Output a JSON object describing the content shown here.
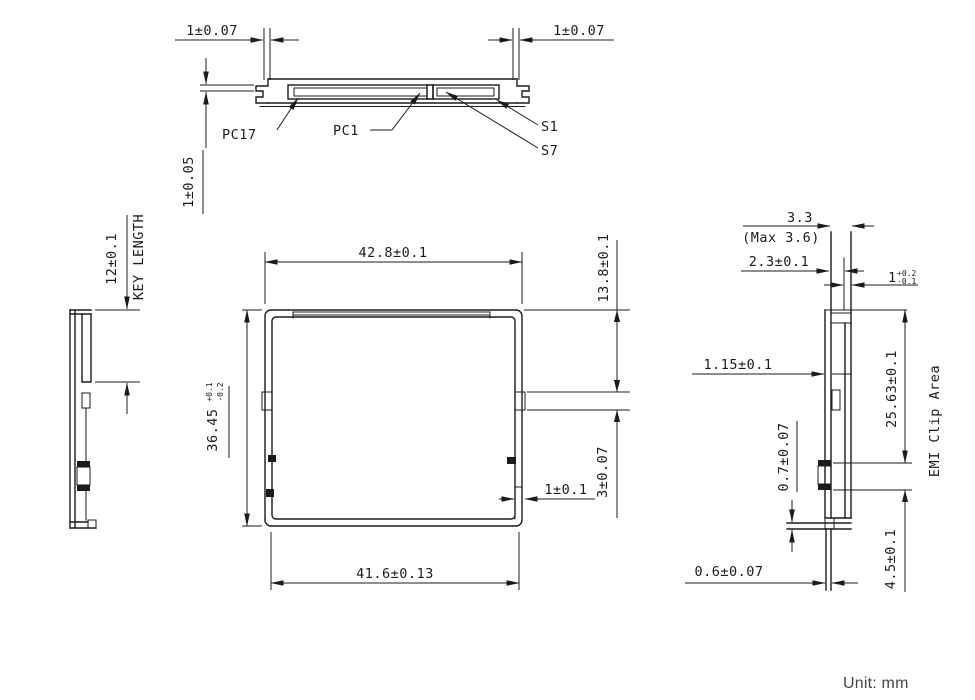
{
  "colors": {
    "line": "#1b1b1b",
    "note_text": "#454545",
    "background": "#ffffff"
  },
  "top_view": {
    "dim_left": "1±0.07",
    "dim_right": "1±0.07",
    "dim_lip": "1±0.05",
    "labels": {
      "pc17": "PC17",
      "pc1": "PC1",
      "s1": "S1",
      "s7": "S7"
    }
  },
  "left_view": {
    "dim_key": "12±0.1",
    "key_caption": "KEY LENGTH"
  },
  "front_view": {
    "dim_width_top": "42.8±0.1",
    "dim_height": {
      "value": "36.45",
      "tol_plus": "+0.1",
      "tol_minus": "-0.2"
    },
    "dim_width_bottom": "41.6±0.13",
    "dim_conn_offset": "13.8±0.1",
    "dim_conn_height": "3±0.07",
    "dim_step": "1±0.1"
  },
  "right_view": {
    "dim_thickness": "3.3",
    "dim_thickness_max": "(Max 3.6)",
    "dim_sub": "2.3±0.1",
    "dim_lip": {
      "value": "1",
      "tol_plus": "+0.2",
      "tol_minus": "-0.1"
    },
    "dim_pcb": "1.15±0.1",
    "dim_tab": "0.7±0.07",
    "dim_emi": "25.63±0.1",
    "emi_label": "EMI Clip Area",
    "dim_bottom_clip": "4.5±0.1",
    "dim_tail": "0.6±0.07"
  },
  "note": {
    "unit": "Unit: mm"
  }
}
